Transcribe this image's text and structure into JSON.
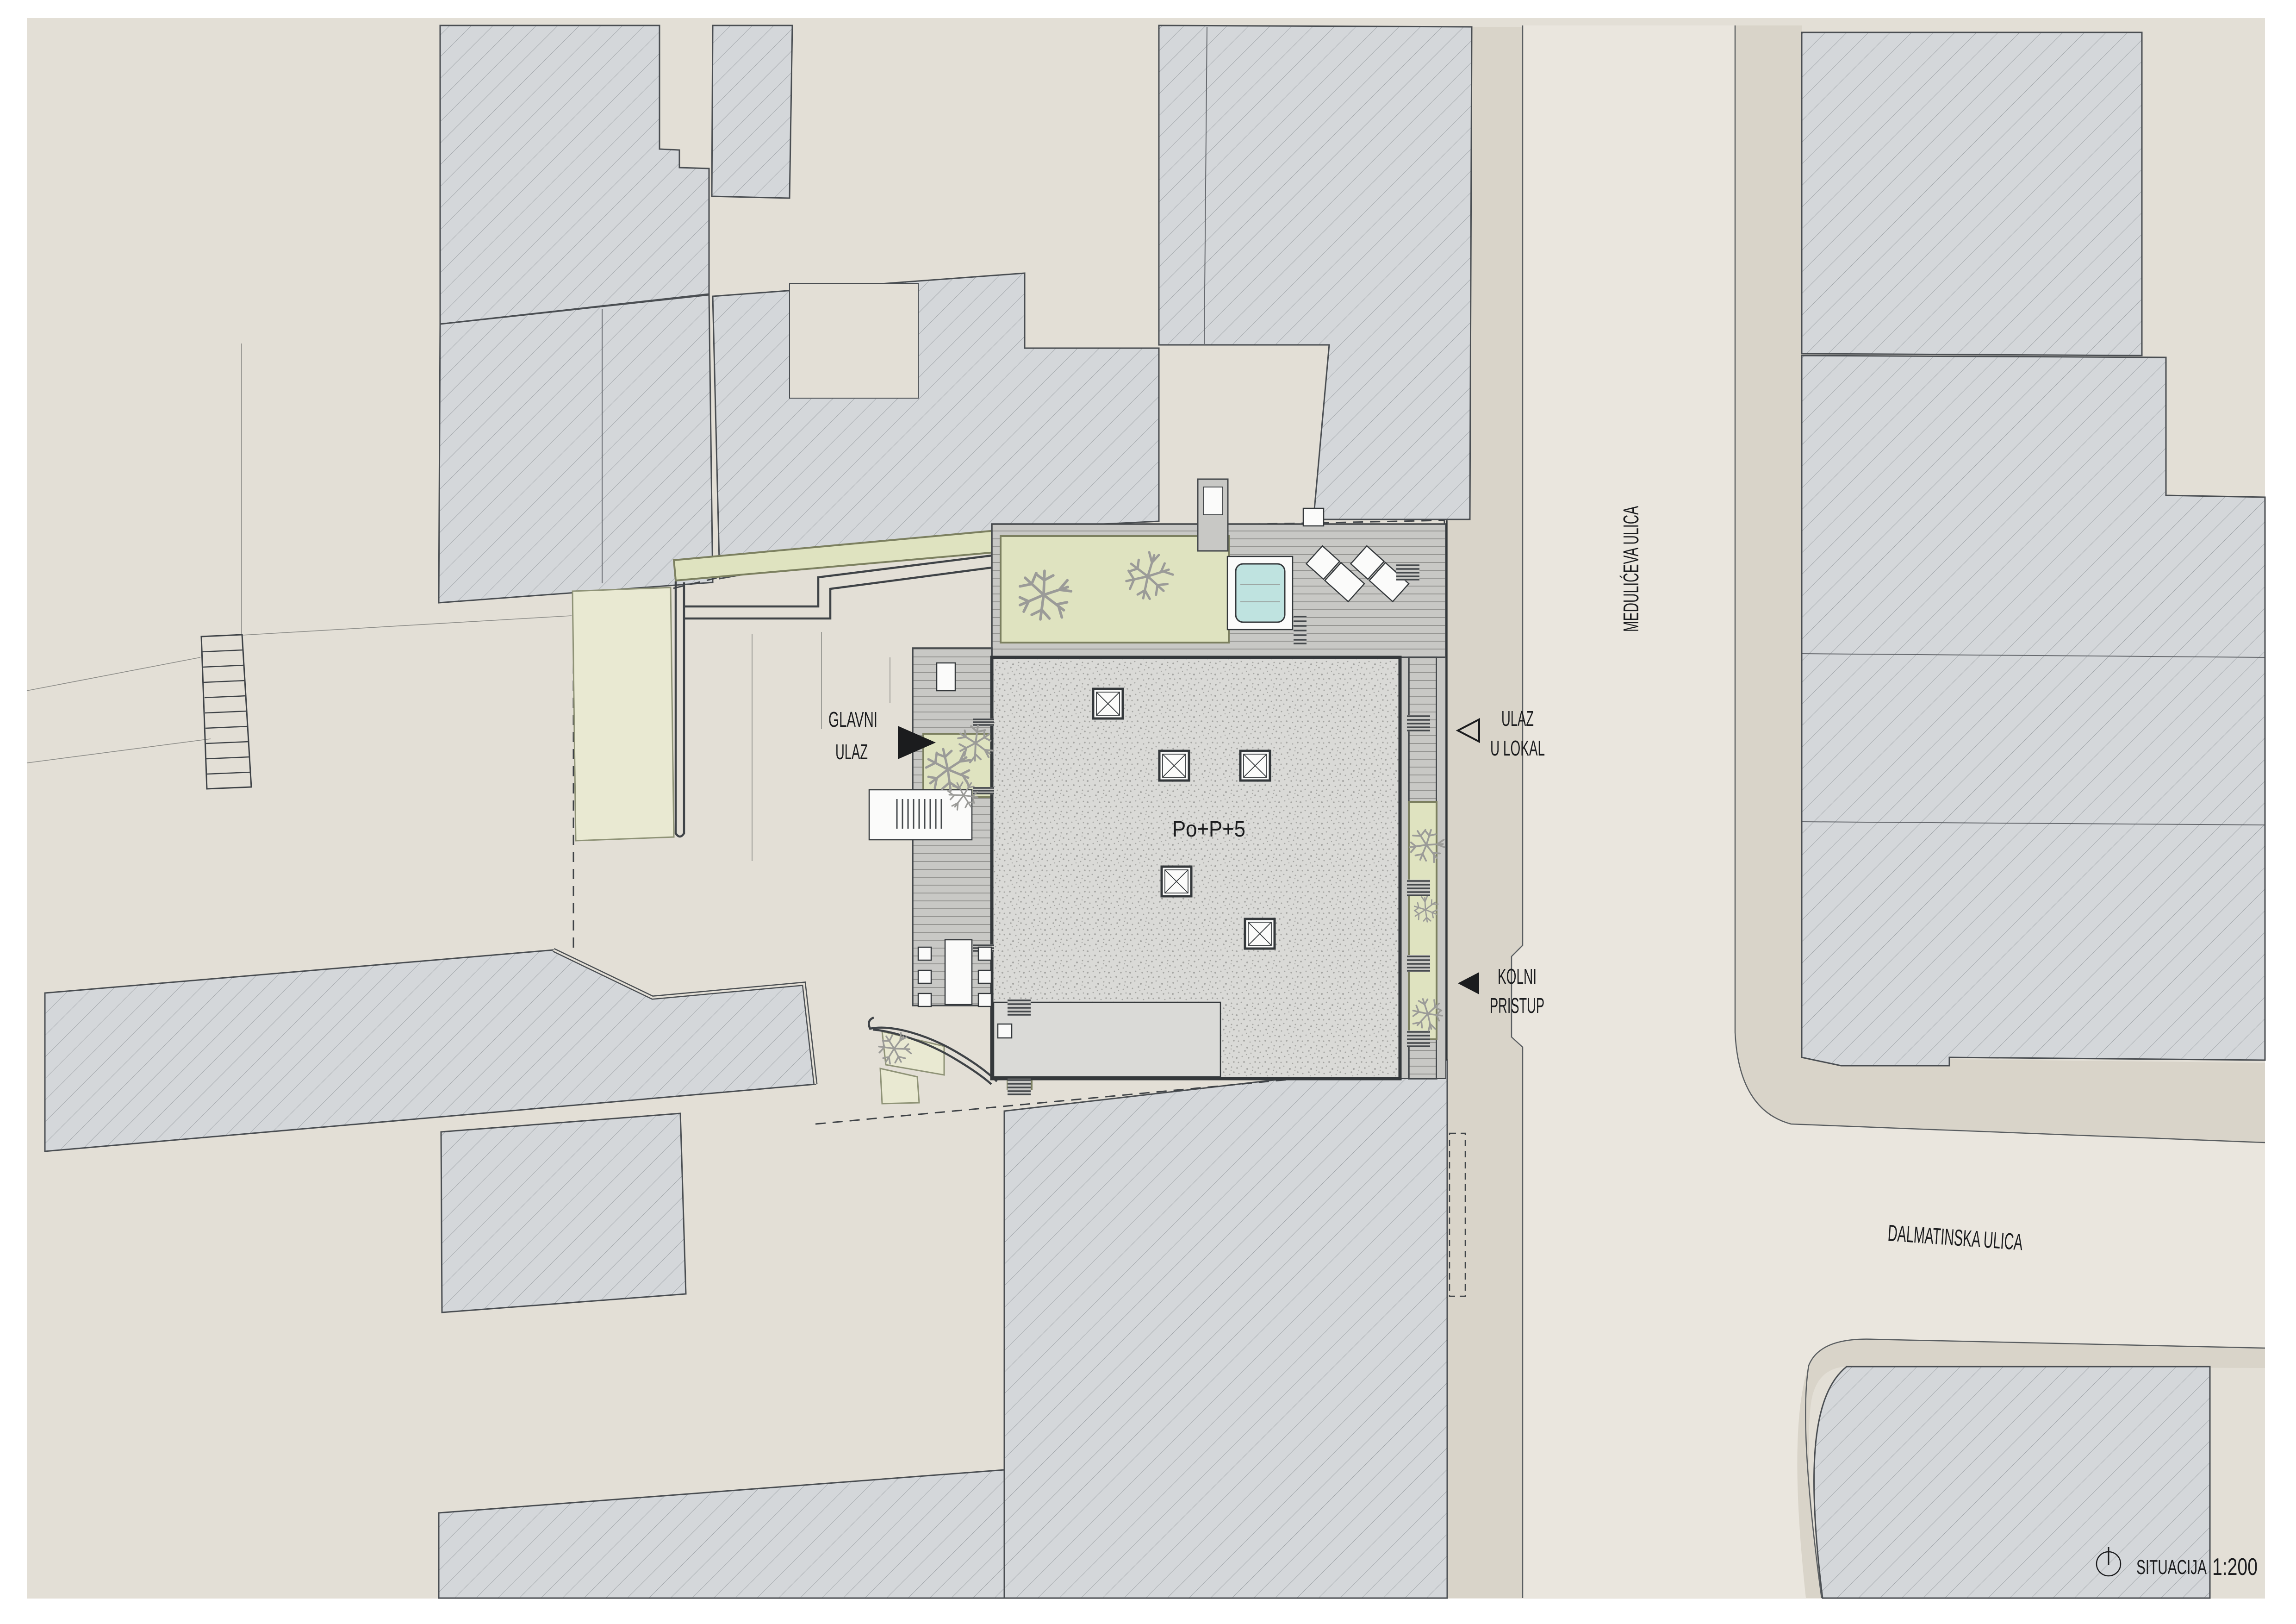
{
  "colors": {
    "paper": "#ffffff",
    "canvas": "#e3dfd6",
    "street": "#eae6de",
    "sidewalk": "#d9d4c9",
    "block_fill": "#d4d7da",
    "hatch_line": "#878c91",
    "block_outline": "#4a4e52",
    "curb_line": "#5a5e61",
    "boundary": "#3f4347",
    "survey_line": "#8d8d89",
    "deck_base": "#c8c8c5",
    "deck_line": "#8f8f8c",
    "deck_outline": "#45494c",
    "roof_base": "#dadad7",
    "roof_dot": "#a5a5a2",
    "roof_outline": "#34383b",
    "planter_green": "#dfe3c0",
    "planter_border": "#7c8060",
    "lawn_green": "#e9e9d2",
    "lawn_border": "#8f9377",
    "pool_water": "#bfe3e0",
    "tree_branch": "#9b9b98",
    "white_element": "#fbfbfa",
    "bench_stripe": "#45494c",
    "ink": "#1b1c1e"
  },
  "site_plan": {
    "title": "SITUACIJA",
    "scale": "1:200",
    "building_label": "Po+P+5",
    "streets": {
      "meduliceva": "MEDULIĆEVA ULICA",
      "dalmatinska": "DALMATINSKA ULICA"
    },
    "annotations": {
      "main_entrance": {
        "line1": "GLAVNI",
        "line2": "ULAZ"
      },
      "local_entrance": {
        "line1": "ULAZ",
        "line2": "U LOKAL"
      },
      "vehicle_access": {
        "line1": "KOLNI",
        "line2": "PRISTUP"
      }
    },
    "icons": {
      "north": "north-indicator-icon",
      "main_entrance_arrow": "filled-triangle-right-icon",
      "local_entrance_arrow": "outline-triangle-left-icon",
      "vehicle_access_arrow": "filled-triangle-left-icon"
    }
  }
}
